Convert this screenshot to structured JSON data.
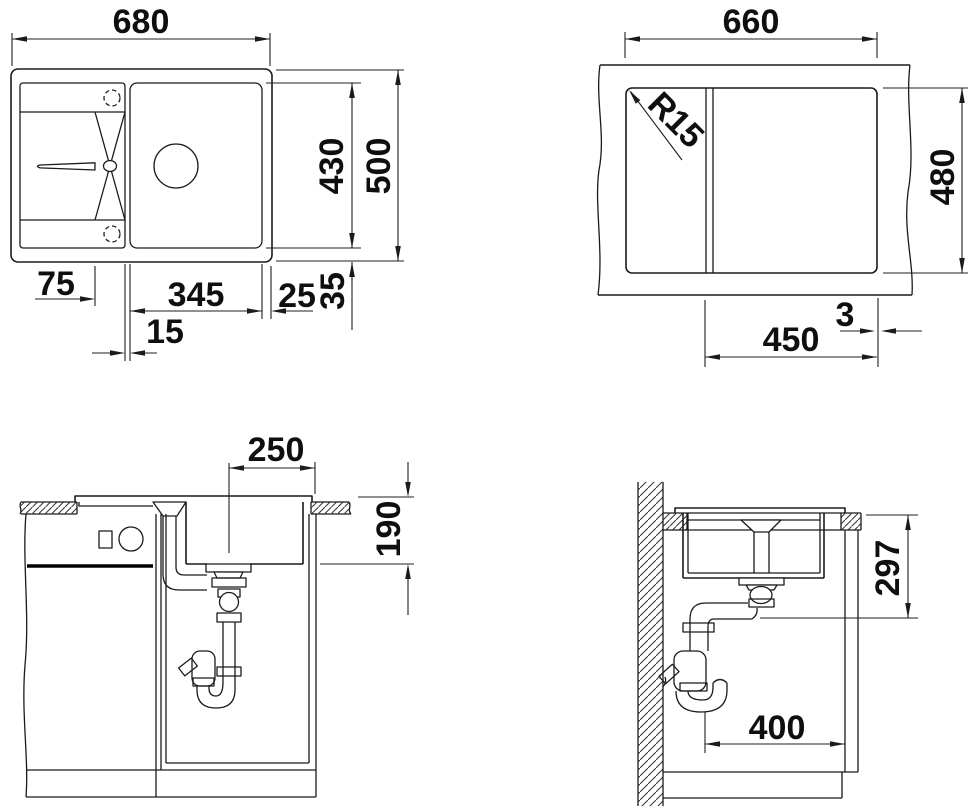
{
  "plan_view": {
    "overall_width": "680",
    "overall_depth": "500",
    "basin_depth": "430",
    "runnel_length": "75",
    "bowl_width": "345",
    "bowl_to_edge": "25",
    "edge_margin": "35",
    "divider_gap": "15"
  },
  "cutout_view": {
    "cutout_width": "660",
    "cutout_depth": "480",
    "corner_radius": "R15",
    "bowl_cutout": "450",
    "offset": "3"
  },
  "front_view": {
    "drain_center_offset": "250",
    "bowl_depth": "190"
  },
  "side_view": {
    "outlet_height": "297",
    "cabinet_clearance": "400"
  }
}
